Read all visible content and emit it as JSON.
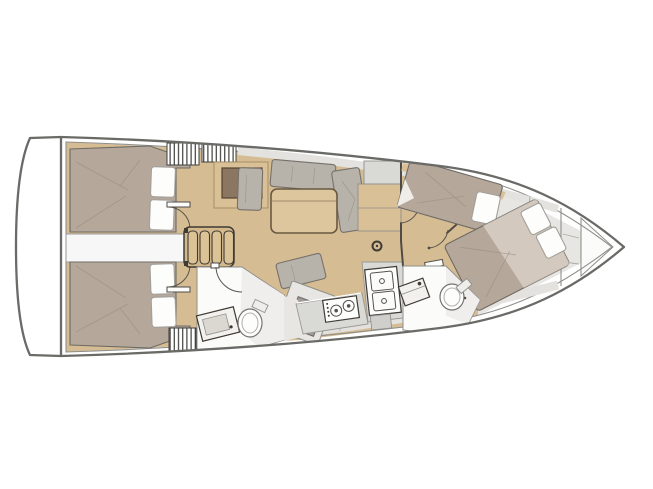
{
  "figure": {
    "type": "sailing-yacht interior floor plan",
    "view": "top-down",
    "orientation": "bow-right",
    "text_labels": []
  },
  "palette": {
    "bg": "#ffffff",
    "outline": "#6a6a67",
    "line": "#8f8f8c",
    "wall": "#4f4c47",
    "floor": "#d5bc92",
    "wood": "#d9c096",
    "dark-wood": "#8b7661",
    "mattress": "#b5a79a",
    "cushion": "#b7b2aa",
    "table": "#ddc59d",
    "table-edge": "#6a5941",
    "white": "#fdfdfc",
    "counter": "#d9d9d6",
    "deck": "#e3e2df",
    "bow-gray": "#e7e6e2",
    "shade": "#efeeec",
    "stripe": "#3f3f3c",
    "crease": "#9a8d81",
    "arc": "#57544e"
  },
  "areas": [
    {
      "name": "swim-platform",
      "features": [
        "transom"
      ]
    },
    {
      "name": "aft-cabin-port",
      "features": [
        "double-berth",
        "pillows",
        "cockpit-locker-hatch",
        "cabin-door"
      ]
    },
    {
      "name": "aft-cabin-starboard",
      "features": [
        "double-berth",
        "pillows",
        "cockpit-locker-hatch",
        "cabin-door"
      ]
    },
    {
      "name": "engine-compartment",
      "features": []
    },
    {
      "name": "companionway-steps",
      "features": [
        "four-treads"
      ]
    },
    {
      "name": "saloon",
      "features": [
        "u-settee",
        "table",
        "bench",
        "nav-table",
        "mast-post",
        "sideboard",
        "storage-cabinet"
      ]
    },
    {
      "name": "aft-head",
      "features": [
        "toilet",
        "washbasin",
        "door"
      ]
    },
    {
      "name": "galley",
      "features": [
        "two-burner-stove",
        "double-sink",
        "counters"
      ]
    },
    {
      "name": "forward-cabin-port",
      "features": [
        "berth",
        "pillow"
      ]
    },
    {
      "name": "forward-cabin-starboard",
      "features": [
        "double-berth",
        "pillows",
        "duvet"
      ]
    },
    {
      "name": "forward-head",
      "features": [
        "toilet",
        "washbasin",
        "door"
      ]
    },
    {
      "name": "bow-section",
      "features": [
        "shelf",
        "bulkheads",
        "anchor-locker"
      ]
    }
  ]
}
